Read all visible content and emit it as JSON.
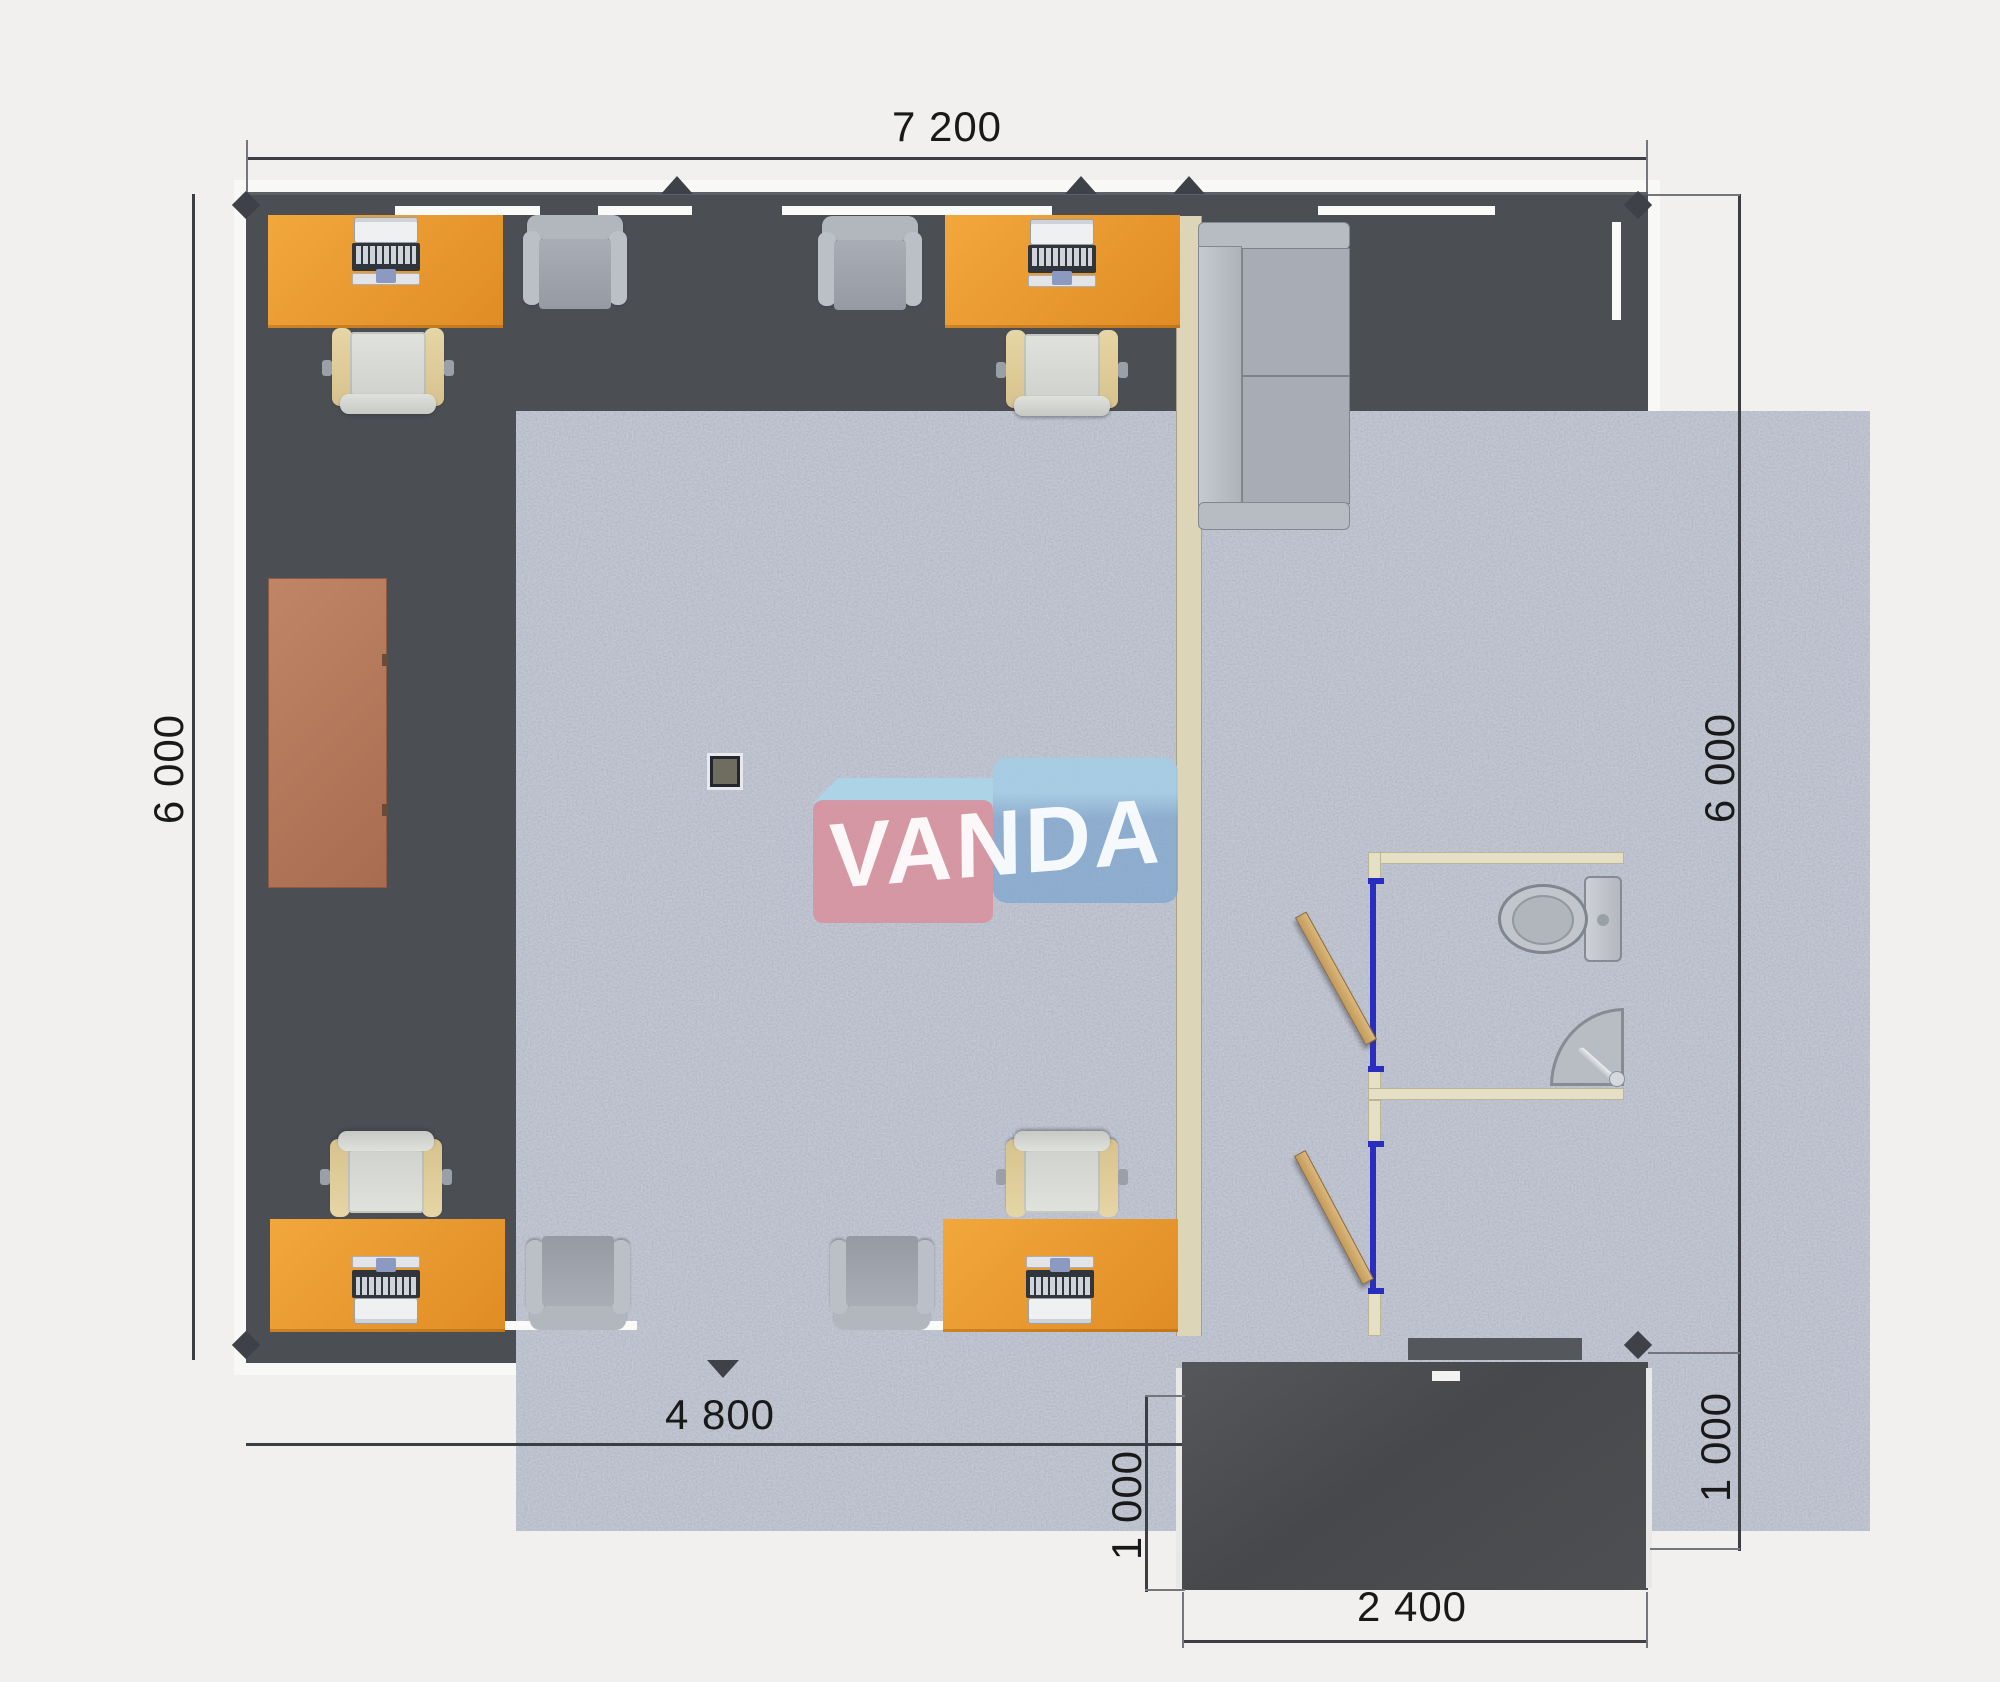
{
  "plan": {
    "watermark": {
      "text": "VANDA"
    },
    "dims": {
      "top": "7 200",
      "left": "6 000",
      "right": "6 000",
      "bottom": "4 800",
      "porch_left": "1 000",
      "porch_right": "1 000",
      "porch_bottom": "2 400"
    },
    "colors": {
      "background": "#f1f0ee",
      "wall": "#4b4e53",
      "floor_base": "#c3c8d3",
      "floor_speckle": "#545c73",
      "desk_orange": "#ea9a2f",
      "chair_frame_beige": "#e0cf9f",
      "armchair_gray": "#aab0b8",
      "cabinet_terracotta": "#b97c5f",
      "sofa_gray": "#adb1b9",
      "partition_beige": "#dcd5b8",
      "door_frame_blue": "#2a2ec0",
      "door_wood": "#cfa96e",
      "porch_dark": "#4a4c4f",
      "fixture_gray": "#bfc3c9",
      "dimension_text": "#191919",
      "logo_pink": "#d88f9b",
      "logo_blue": "#7fa8d2",
      "logo_light_blue": "#a9d6ea"
    },
    "furniture_icons": [
      "desk",
      "laptop",
      "task-chair",
      "armchair",
      "cabinet",
      "sofa",
      "toilet",
      "sink",
      "door-leaf",
      "floor-box"
    ]
  }
}
